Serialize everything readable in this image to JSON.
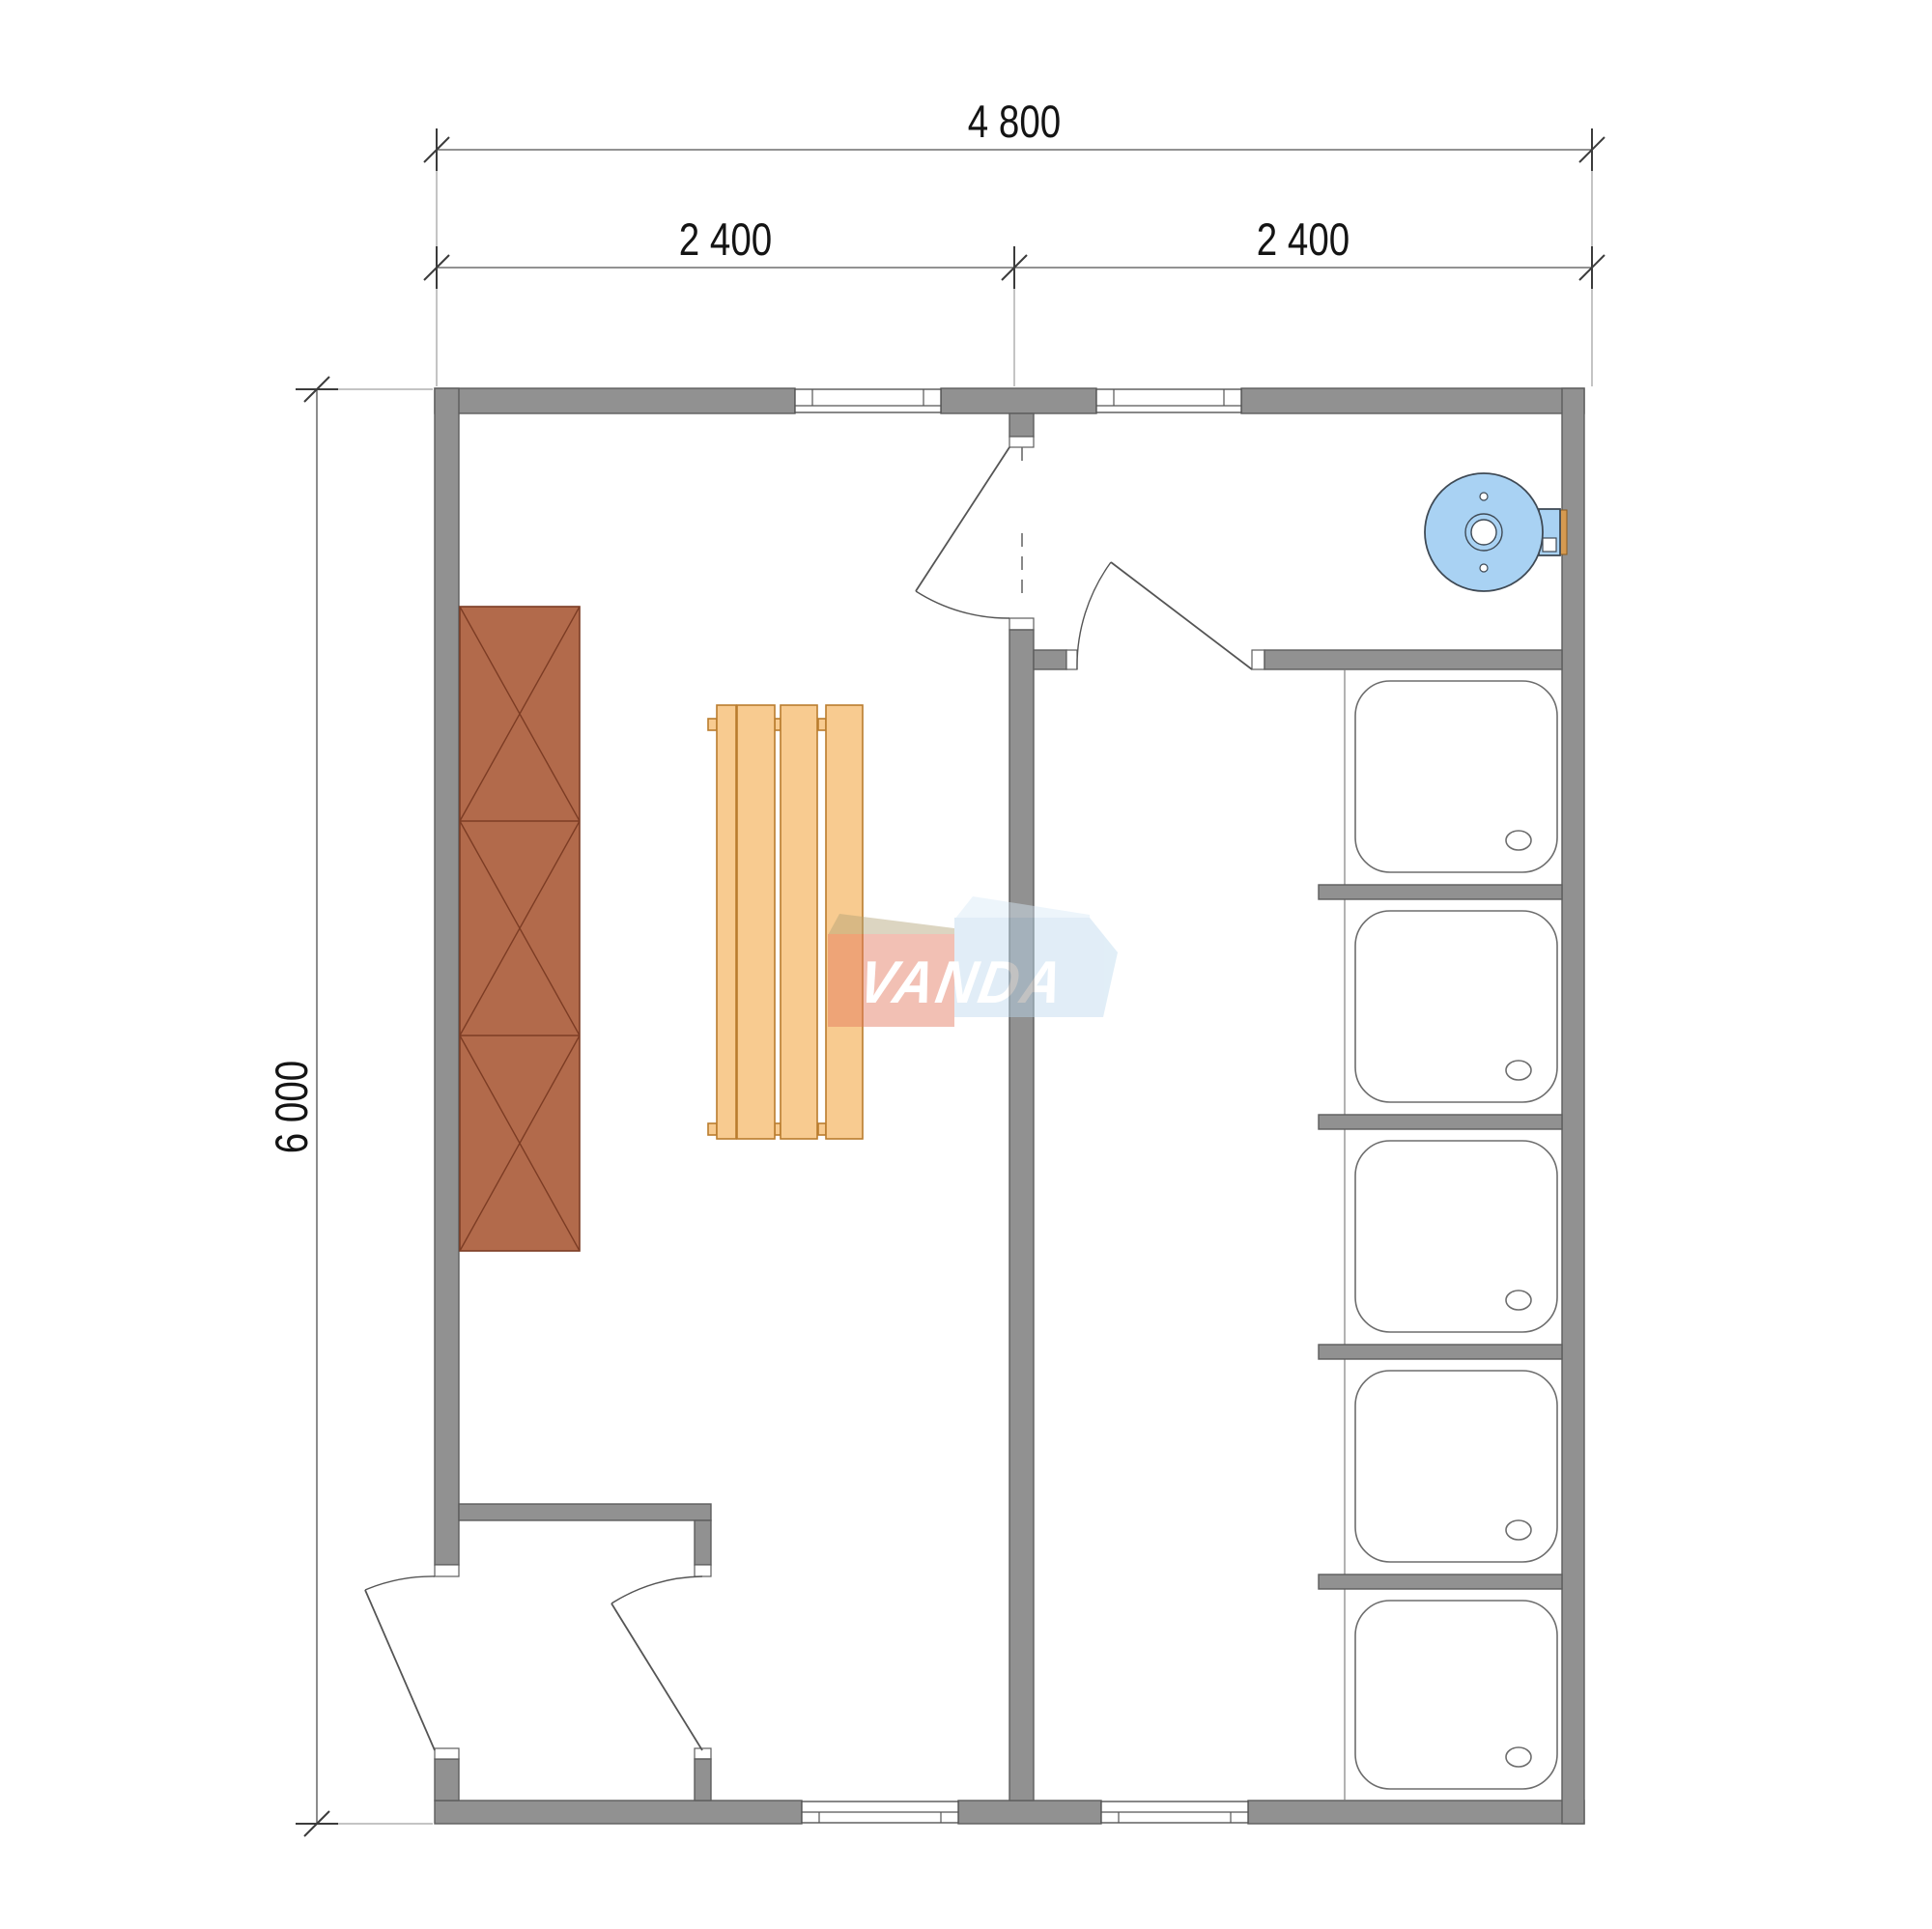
{
  "title": "Bathhouse floor plan 4800 x 6000",
  "dimensions": {
    "width_total": {
      "label": "4 800"
    },
    "width_left": {
      "label": "2 400"
    },
    "width_right": {
      "label": "2 400"
    },
    "height_total": {
      "label": "6 000"
    }
  },
  "watermark": {
    "text": "VANDA"
  },
  "fixtures": {
    "shower_trays": 5,
    "shower_partitions": 4,
    "wardrobe_sections": 3,
    "bench_slats": 4,
    "water_heaters": 1,
    "doors": 4,
    "windows": 4
  },
  "colors": {
    "wall": "#919191",
    "wall_stroke": "#5d5d5d",
    "line": "#555555",
    "wardrobe": "#b26a4b",
    "wardrobe_stroke": "#7c3c24",
    "bench": "#f8cb90",
    "bench_stroke": "#b97c2e",
    "heater": "#a9d2f3",
    "wm_red": "#e4765a",
    "wm_red_bevel": "#b3a377",
    "wm_blue": "#bdd9ee",
    "wm_blue_bevel": "#d9eaf7",
    "wm_text": "#ffffff"
  }
}
